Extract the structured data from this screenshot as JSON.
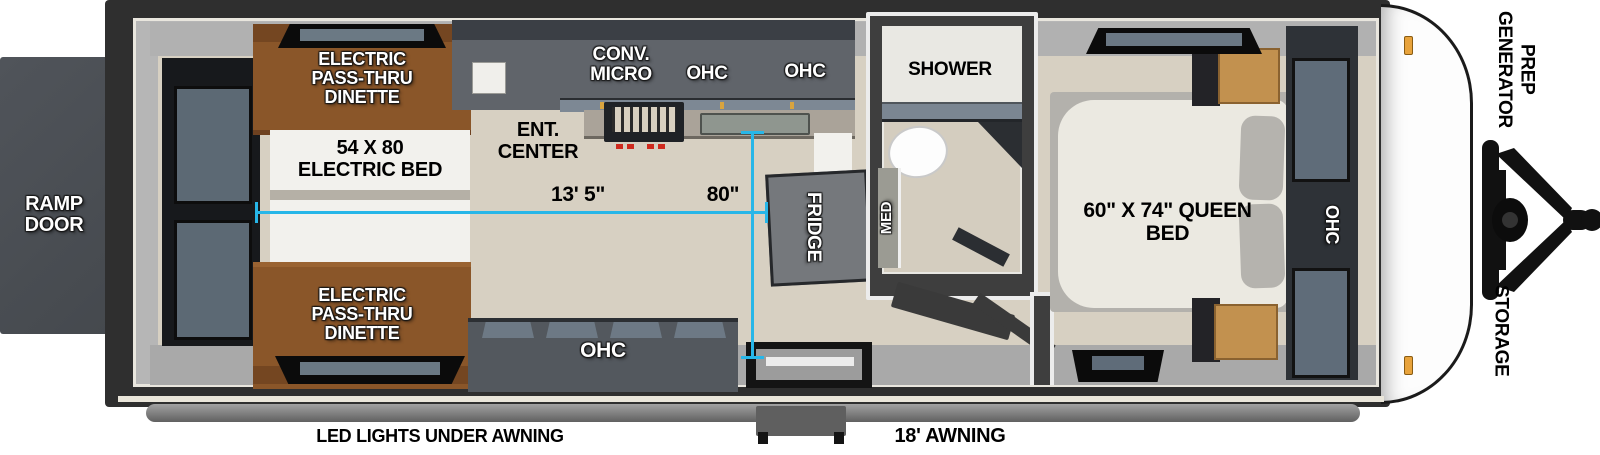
{
  "colors": {
    "dimension_line": "#27b6e8",
    "dinette_brown": "#8a5629",
    "cabinet_gray": "#5a5f65",
    "dark_wood": "#2e3237",
    "mattress_white": "#ebe9e1",
    "floor_wood": "#d7d0c2",
    "ramp_door_gray": "#4c5055",
    "accent_amber": "#d9a43f"
  },
  "labels": {
    "ramp_door": "RAMP DOOR",
    "dinette_top": "ELECTRIC PASS-THRU DINETTE",
    "electric_bed": "54 X 80 ELECTRIC BED",
    "dinette_bottom": "ELECTRIC PASS-THRU DINETTE",
    "ent_center": "ENT. CENTER",
    "conv_micro": "CONV. MICRO",
    "ohc_kitchen_1": "OHC",
    "ohc_kitchen_2": "OHC",
    "ohc_lower": "OHC",
    "fridge": "FRIDGE",
    "shower": "SHOWER",
    "med": "MED",
    "queen_bed": "60\" X 74\" QUEEN BED",
    "ohc_bedroom": "OHC",
    "generator_prep": "GENERATOR PREP",
    "storage": "STORAGE"
  },
  "dimensions": {
    "interior_length": "13' 5\"",
    "galley_width": "80\""
  },
  "exterior": {
    "led_lights": "LED LIGHTS UNDER AWNING",
    "awning": "18' AWNING"
  }
}
